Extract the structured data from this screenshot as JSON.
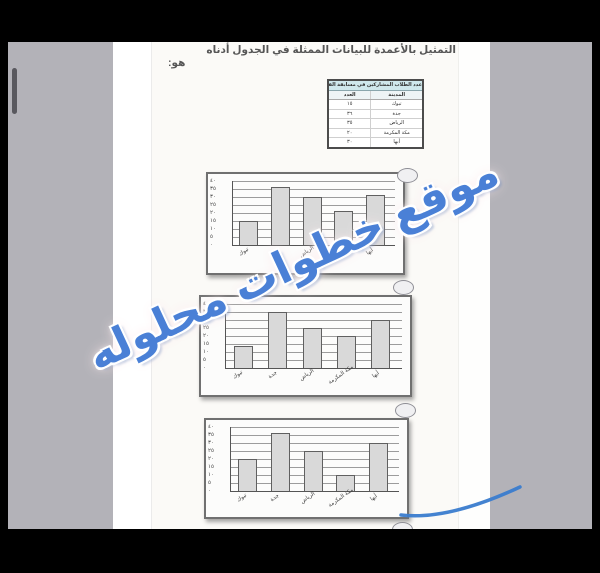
{
  "question": {
    "title": "التمثيل بالأعمدة للبيانات الممثلة في الجدول أدناه",
    "title_tail": "هو:"
  },
  "data_table": {
    "title": "عدد الطلاب المشاركين في مسابقة القرآن",
    "col_city": "المدينة",
    "col_count": "العدد",
    "rows": [
      {
        "city": "تبوك",
        "count": "١٥"
      },
      {
        "city": "جدة",
        "count": "٣٦"
      },
      {
        "city": "الرياض",
        "count": "٣٥"
      },
      {
        "city": "مكة المكرمة",
        "count": "٢٠"
      },
      {
        "city": "أبها",
        "count": "٣٠"
      }
    ]
  },
  "chart_data": [
    {
      "type": "bar",
      "option_index": 1,
      "categories": [
        "تبوك",
        "جدة",
        "الرياض",
        "مكة المكرمة",
        "أبها"
      ],
      "values": [
        15,
        36,
        30,
        21,
        31
      ],
      "ylim": [
        0,
        40
      ],
      "ytick_step": 5,
      "ytick_labels_top_to_bottom": [
        "٤٠",
        "٣٥",
        "٣٠",
        "٢٥",
        "٢٠",
        "١٥",
        "١٠",
        "٥",
        "٠"
      ],
      "grid": true,
      "title": "",
      "xlabel": "",
      "ylabel": ""
    },
    {
      "type": "bar",
      "option_index": 2,
      "categories": [
        "تبوك",
        "جدة",
        "الرياض",
        "مكة المكرمة",
        "أبها"
      ],
      "values": [
        14,
        35,
        25,
        20,
        30
      ],
      "ylim": [
        0,
        40
      ],
      "ytick_step": 5,
      "ytick_labels_top_to_bottom": [
        "٤٠",
        "٣٥",
        "٣٠",
        "٢٥",
        "٢٠",
        "١٥",
        "١٠",
        "٥",
        "٠"
      ],
      "grid": true,
      "title": "",
      "xlabel": "",
      "ylabel": ""
    },
    {
      "type": "bar",
      "option_index": 3,
      "categories": [
        "تبوك",
        "جدة",
        "الرياض",
        "مكة المكرمة",
        "أبها"
      ],
      "values": [
        20,
        36,
        25,
        10,
        30
      ],
      "ylim": [
        0,
        40
      ],
      "ytick_step": 5,
      "ytick_labels_top_to_bottom": [
        "٤٠",
        "٣٥",
        "٣٠",
        "٢٥",
        "٢٠",
        "١٥",
        "١٠",
        "٥",
        "٠"
      ],
      "grid": true,
      "title": "",
      "xlabel": "",
      "ylabel": ""
    }
  ],
  "options": {
    "radio_count": 4
  },
  "watermark": {
    "text": "موقع خطوات محلوله"
  },
  "annotations": {
    "pen_color": "#3a7ccd"
  },
  "colors": {
    "canvas_gray": "#b3b2b8",
    "page_white": "#fbfaf7",
    "table_header_bg": "#cfe7ec",
    "bar_fill": "#d9d9d9",
    "watermark_blue": "#4a80d6",
    "pen_blue": "#3a7ccd"
  }
}
